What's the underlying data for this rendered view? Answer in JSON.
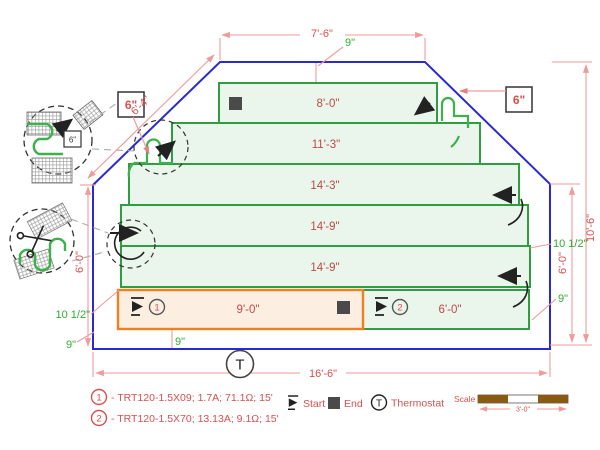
{
  "diagram_title": "radiant-floor-heating-mat-layout",
  "rows": [
    {
      "label": "8'-0\""
    },
    {
      "label": "11'-3\""
    },
    {
      "label": "14'-3\""
    },
    {
      "label": "14'-9\""
    },
    {
      "label": "14'-9\""
    },
    {
      "label": "9'-0\"",
      "num": "1"
    },
    {
      "label": "6'-0\"",
      "num": "2"
    }
  ],
  "dimensions": {
    "top": "7'-6\"",
    "slant": "6'-4\"",
    "left": "6'-0\"",
    "right_inner": "6'-0\"",
    "right_outer": "10'-6\"",
    "bottom": "16'-6\""
  },
  "annotations": {
    "nine": "9\"",
    "ten_half": "10 1/2\"",
    "six": "6\""
  },
  "legend": {
    "items": [
      {
        "num": "1",
        "text": "- TRT120-1.5X09; 1.7A; 71.1Ω; 15'"
      },
      {
        "num": "2",
        "text": "- TRT120-1.5X70; 13.13A; 9.1Ω; 15'"
      }
    ],
    "start": "Start",
    "end": "End",
    "thermostat": "Thermostat",
    "thermostat_symbol": "T"
  },
  "scale": {
    "label": "Scale",
    "value": "3'-0\""
  },
  "colors": {
    "outline_blue": "#2a2ad2",
    "mat_green": "#2f9e41",
    "mat_fill": "#eaf5ec",
    "orange": "#f07f1f",
    "orange_fill": "#fdeee2",
    "dim_line": "#f19a9a",
    "dim_text": "#d94f4f",
    "green_text": "#2fae2f",
    "scale_brown": "#8a5a13"
  }
}
